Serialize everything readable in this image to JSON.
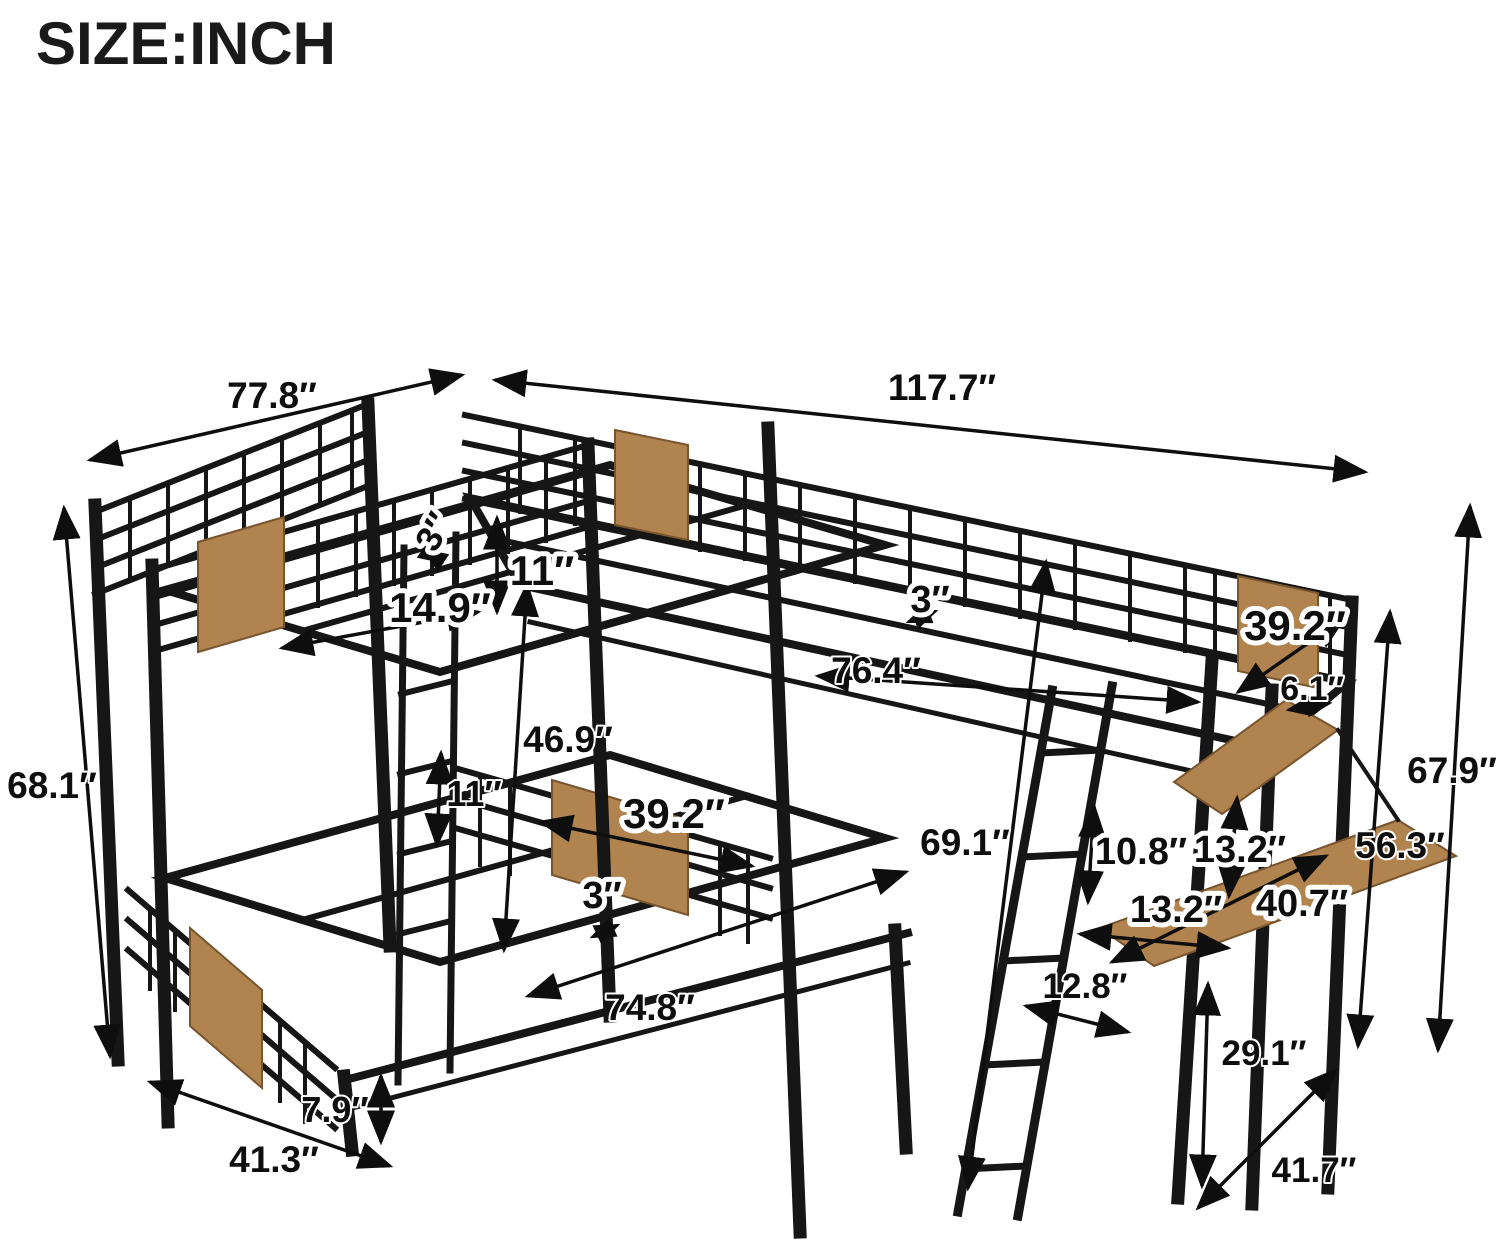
{
  "title": "SIZE:INCH",
  "diagram_subject": "L-shaped triple bunk bed with loft and desk, isometric line drawing with dimension arrows",
  "colors": {
    "background": "#ffffff",
    "frame": "#161616",
    "wood": "#b0834f",
    "wood_edge": "#79552e",
    "label_text": "#0e0e0e",
    "label_halo": "#ffffff"
  },
  "dims": {
    "d77_8": "77.8″",
    "d117_7": "117.7″",
    "d68_1": "68.1″",
    "d3_top": "3″",
    "d11_top": "11″",
    "d14_9": "14.9″",
    "d3_mid": "3″",
    "d76_4": "76.4″",
    "d39_2_right": "39.2″",
    "d6_1": "6.1″",
    "d67_9": "67.9″",
    "d56_3": "56.3″",
    "d69_1": "69.1″",
    "d10_8": "10.8″",
    "d13_2_shelf": "13.2″",
    "d13_2_desk": "13.2″",
    "d40_7": "40.7″",
    "d46_9": "46.9″",
    "d11_bottom": "11″",
    "d39_2_bottom": "39.2″",
    "d3_bottom": "3″",
    "d74_8": "74.8″",
    "d7_9": "7.9″",
    "d41_3": "41.3″",
    "d12_8": "12.8″",
    "d29_1": "29.1″",
    "d41_7": "41.7″"
  }
}
